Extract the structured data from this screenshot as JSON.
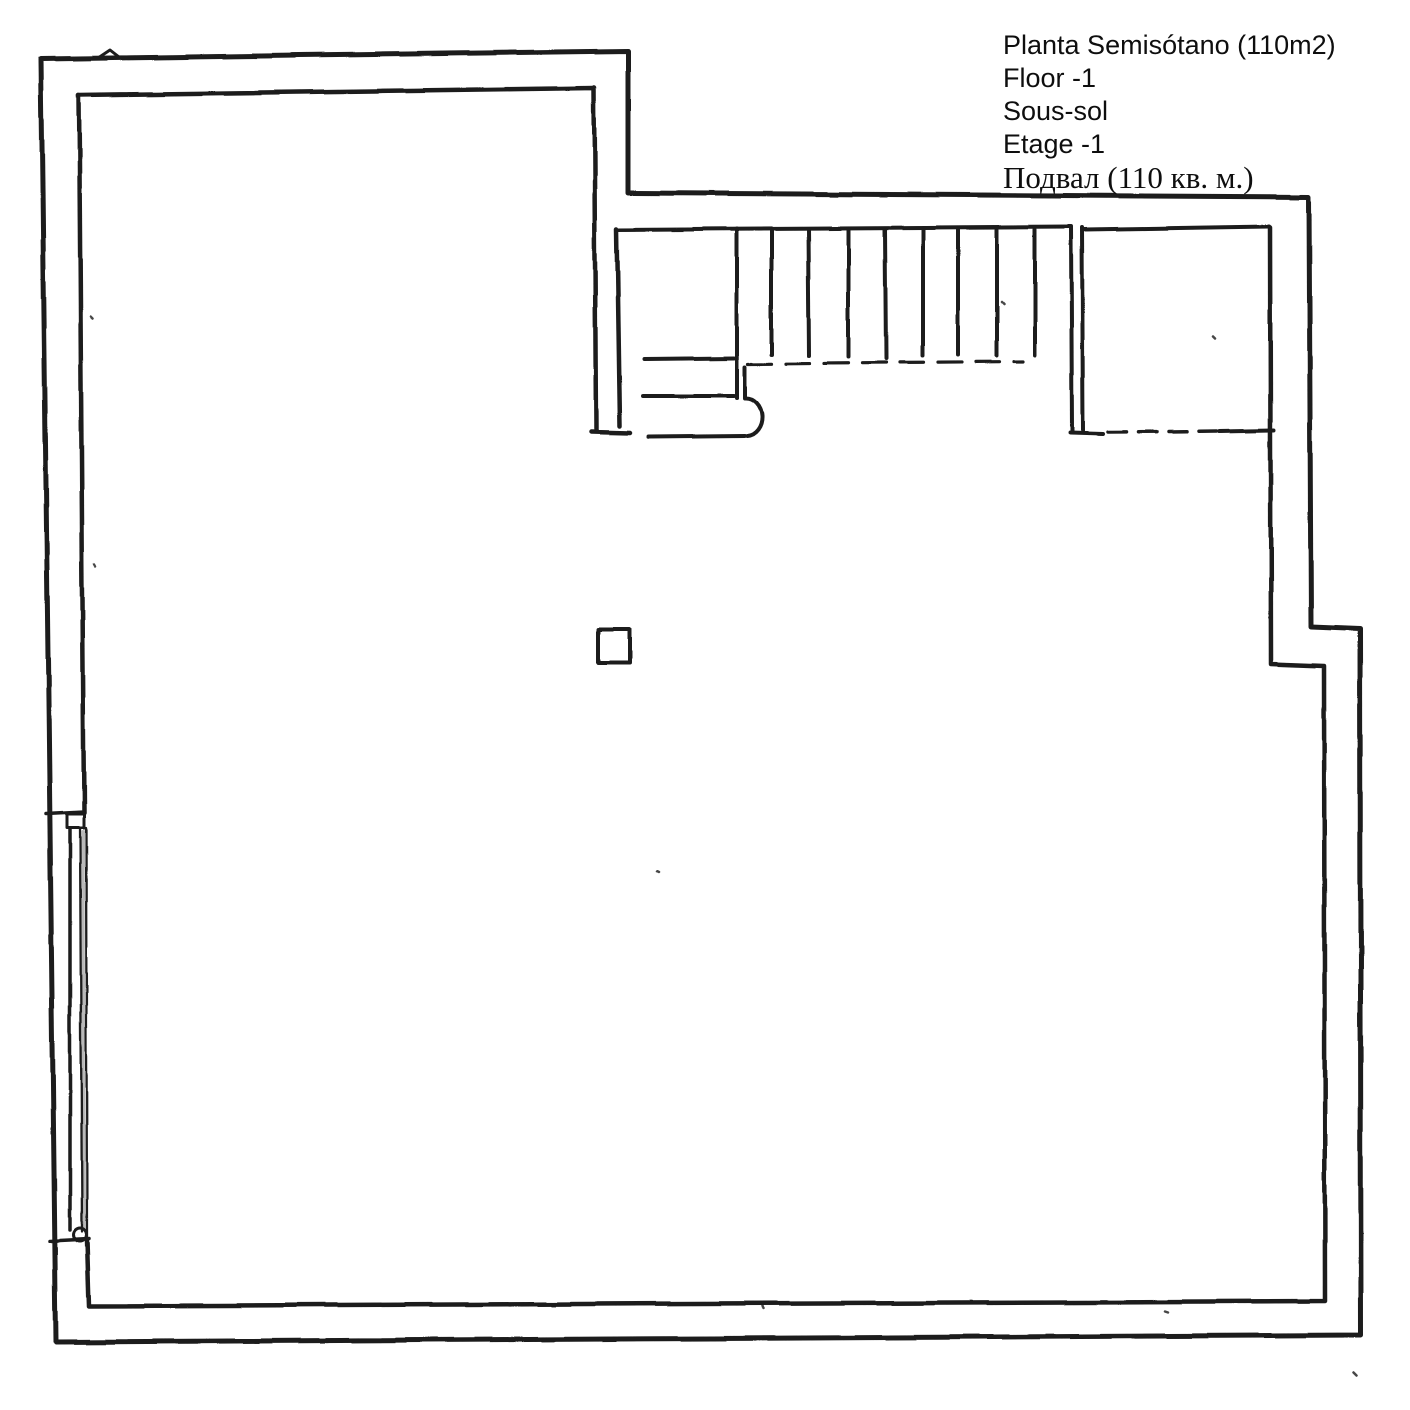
{
  "canvas": {
    "paper_color": "#ffffff",
    "ink_color": "#1b1b1b"
  },
  "title_block": {
    "lines": [
      "Planta Semisótano (110m2)",
      "Floor -1",
      "Sous-sol",
      "Etage -1",
      "Подвал (110 кв. м.)"
    ]
  }
}
